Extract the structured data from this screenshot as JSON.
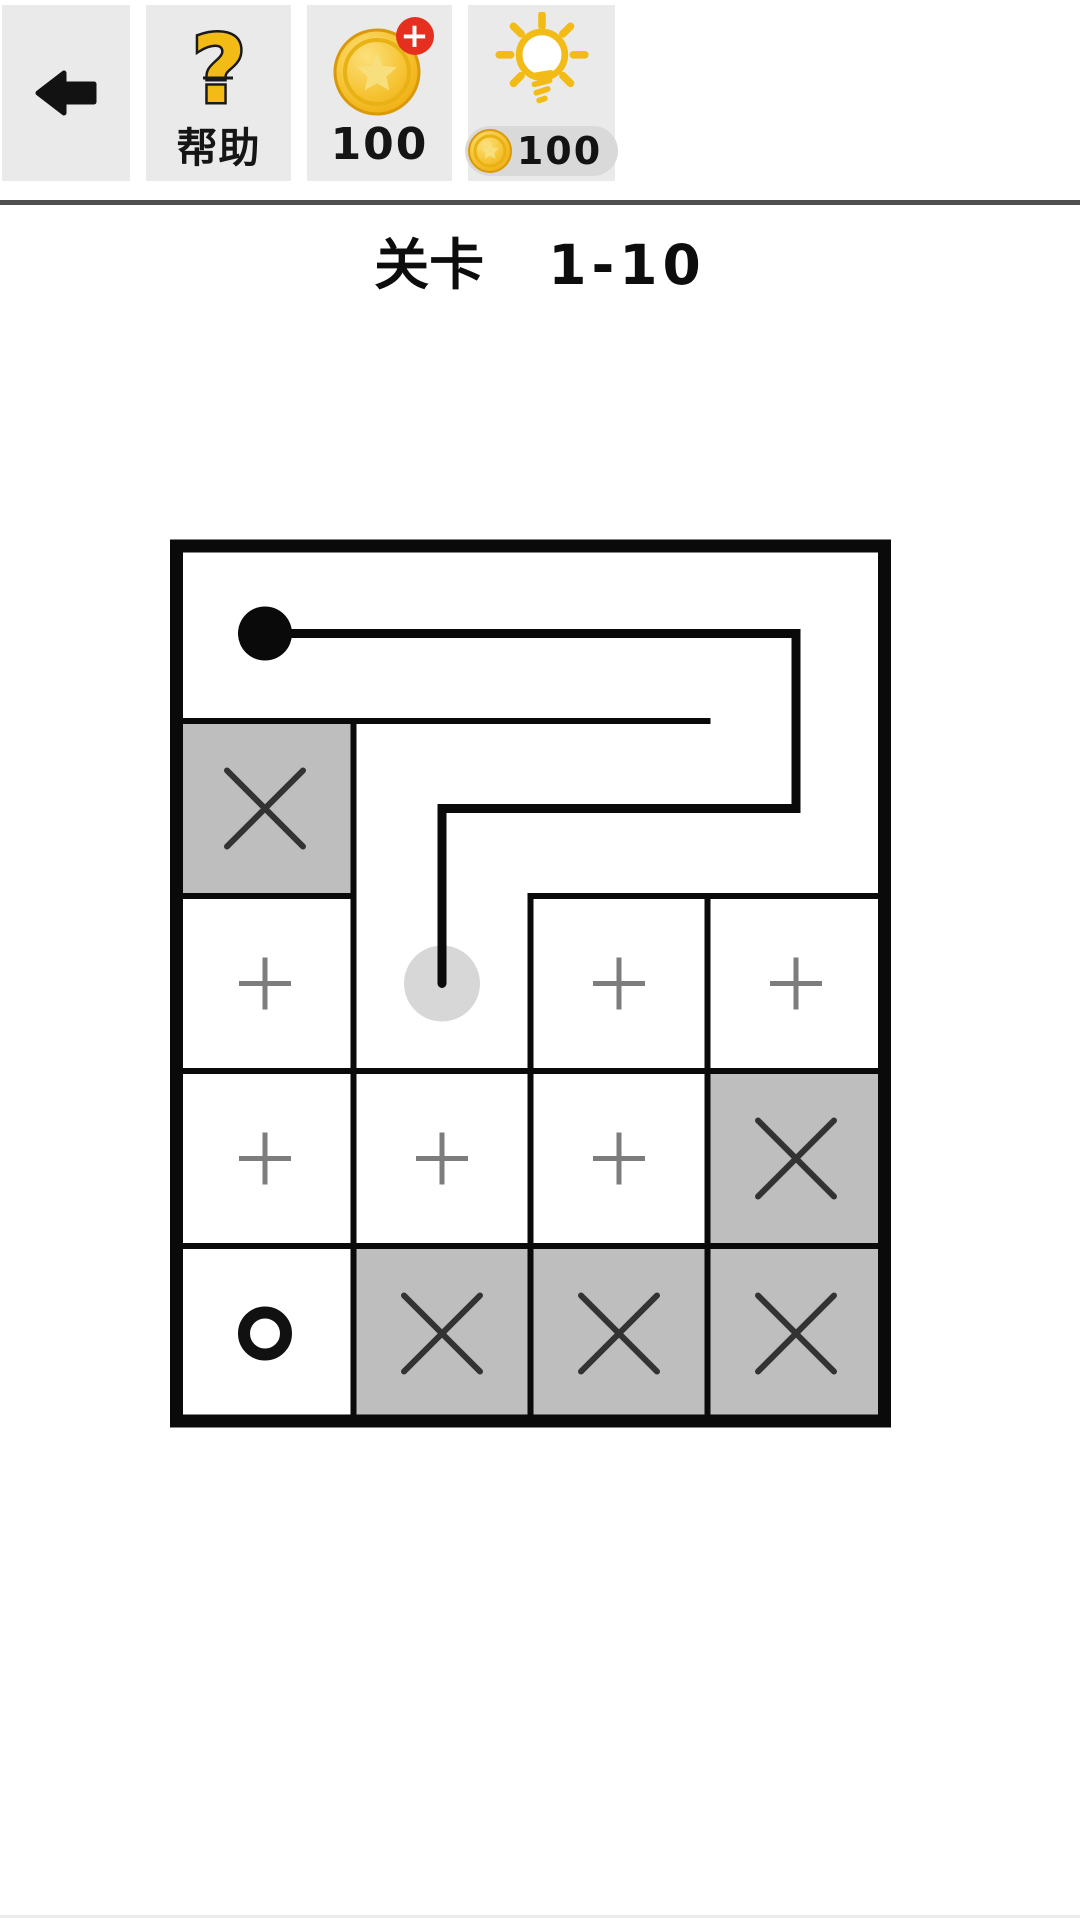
{
  "header": {
    "help_label": "帮助",
    "coin_count": "100",
    "coin_badge": "+",
    "hint_cost": "100"
  },
  "title": {
    "prefix": "关卡",
    "level": "1-10"
  },
  "board": {
    "rows": 5,
    "cols": 4,
    "cell_types": [
      [
        "open",
        "open",
        "open",
        "open"
      ],
      [
        "blocked",
        "open",
        "open",
        "open"
      ],
      [
        "plus",
        "cursor",
        "plus",
        "plus"
      ],
      [
        "plus",
        "plus",
        "plus",
        "blocked"
      ],
      [
        "goal",
        "blocked",
        "blocked",
        "blocked"
      ]
    ],
    "walls": {
      "h": [
        {
          "row": 1,
          "from": 0,
          "to": 3
        },
        {
          "row": 2,
          "from": 0,
          "to": 1
        },
        {
          "row": 2,
          "from": 2,
          "to": 4
        },
        {
          "row": 3,
          "from": 0,
          "to": 4
        },
        {
          "row": 4,
          "from": 0,
          "to": 4
        }
      ],
      "v": [
        {
          "col": 1,
          "from": 1,
          "to": 5
        },
        {
          "col": 2,
          "from": 2,
          "to": 5
        },
        {
          "col": 3,
          "from": 2,
          "to": 5
        }
      ]
    },
    "path": {
      "start_cell": [
        0,
        0
      ],
      "points_cells": [
        [
          0,
          0
        ],
        [
          3,
          0
        ],
        [
          3,
          1
        ],
        [
          1,
          1
        ],
        [
          1,
          2
        ]
      ],
      "cursor_cell": [
        1,
        2
      ]
    }
  },
  "colors": {
    "path": "#0a0a0a",
    "wall": "#0a0a0a",
    "cell_blocked": "#bebebe",
    "x_mark": "#333333",
    "plus_mark": "#7d7d7d",
    "goal_ring": "#111111",
    "cursor": "#d7d7d7",
    "tile_bg": "#eaeaea",
    "pill_bg": "#d9d9d9",
    "divider": "#4f4f4f",
    "gold": "#f2bb16",
    "gold_light": "#fce07c",
    "gold_mid": "#efaa0a",
    "gold_dark": "#d9990a",
    "badge_red": "#e5301f"
  }
}
